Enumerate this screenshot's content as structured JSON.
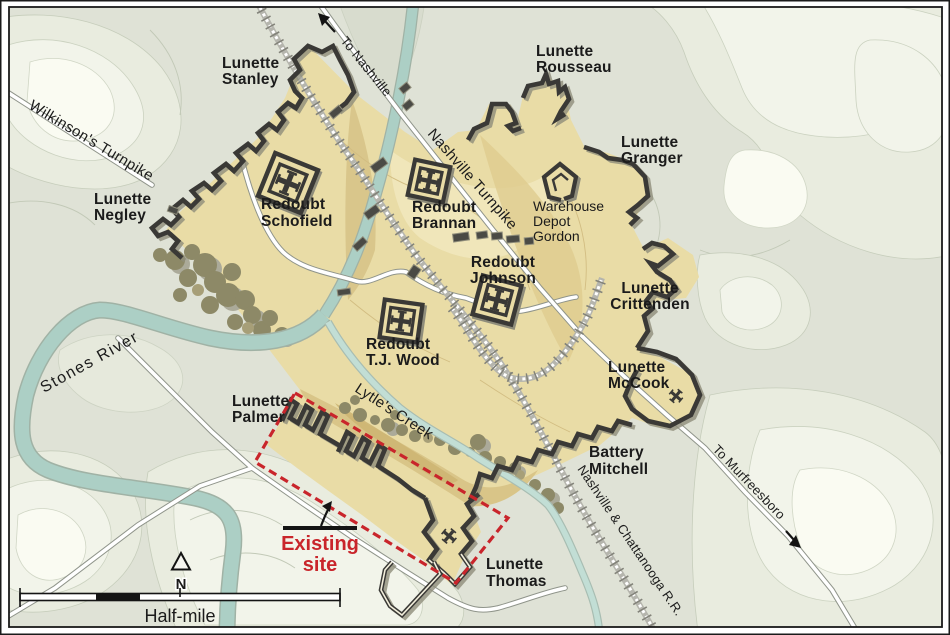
{
  "map": {
    "region_labels": {
      "wilkinsons_turnpike": "Wilkinson's Turnpike",
      "to_nashville": "To Nashville",
      "nashville_turnpike": "Nashville Turnpike",
      "stones_river": "Stones River",
      "lytles_creek": "Lytle's Creek",
      "nashville_chattanooga_rr": "Nashville & Chattanooga R.R.",
      "to_murfreesboro": "To Murfreesboro"
    },
    "fortifications": {
      "lunette_stanley": {
        "line1": "Lunette",
        "line2": "Stanley"
      },
      "lunette_negley": {
        "line1": "Lunette",
        "line2": "Negley"
      },
      "redoubt_schofield": {
        "line1": "Redoubt",
        "line2": "Schofield"
      },
      "lunette_rousseau": {
        "line1": "Lunette",
        "line2": "Rousseau"
      },
      "lunette_granger": {
        "line1": "Lunette",
        "line2": "Granger"
      },
      "redoubt_brannan": {
        "line1": "Redoubt",
        "line2": "Brannan"
      },
      "warehouse_depot_gordon": {
        "line1": "Warehouse",
        "line2": "Depot",
        "line3": "Gordon"
      },
      "redoubt_johnson": {
        "line1": "Redoubt",
        "line2": "Johnson"
      },
      "lunette_crittenden": {
        "line1": "Lunette",
        "line2": "Crittenden"
      },
      "redoubt_tj_wood": {
        "line1": "Redoubt",
        "line2": "T.J. Wood"
      },
      "lunette_mccook": {
        "line1": "Lunette",
        "line2": "McCook"
      },
      "lunette_palmer": {
        "line1": "Lunette",
        "line2": "Palmer"
      },
      "battery_mitchell": {
        "line1": "Battery",
        "line2": "Mitchell"
      },
      "lunette_thomas": {
        "line1": "Lunette",
        "line2": "Thomas"
      }
    },
    "annotations": {
      "existing_site": {
        "line1": "Existing",
        "line2": "site"
      }
    },
    "scale_bar": {
      "label": "Half-mile"
    },
    "compass": {
      "north_label": "N"
    },
    "colors": {
      "terrain_base": "#dfe2d6",
      "fort_interior": "#e9dca6",
      "river": "#accfc5",
      "creek": "#c2ded5",
      "wall": "#3a3936",
      "railroad": "#b5b5ad",
      "road": "#ffffff",
      "highlight_red": "#c9252b",
      "label": "#1b1b1b"
    }
  }
}
